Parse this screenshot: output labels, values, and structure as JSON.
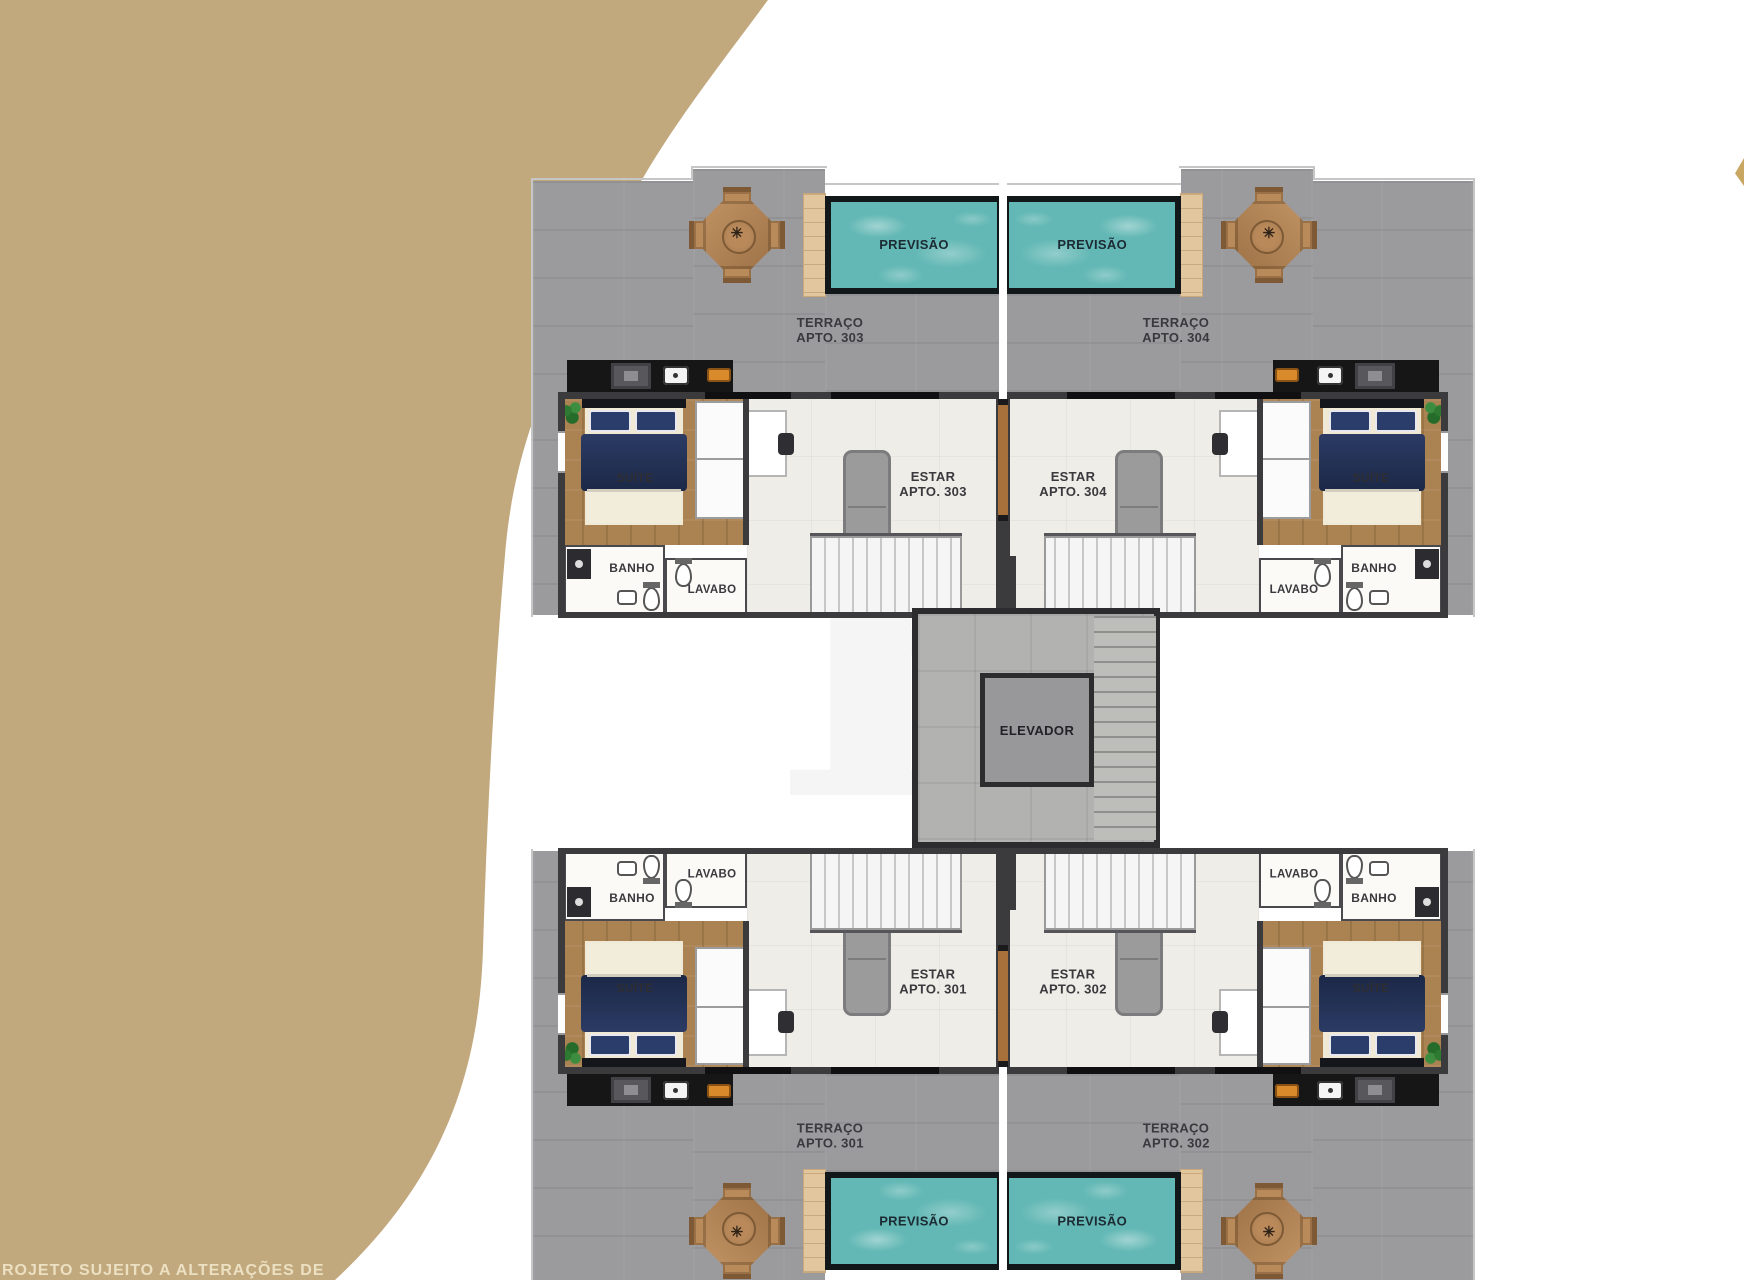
{
  "page": {
    "footer_note": "ROJETO SUJEITO A ALTERAÇÕES DE",
    "watermark_letter": "R",
    "icons": {
      "table_center": "✳"
    },
    "colors": {
      "blob": "#c2a87d",
      "terrace_concrete": "#9b9b9d",
      "pool_water": "#63b8b5",
      "pool_border": "#12171a",
      "deck_wood": "#e2c79e",
      "suite_wood": "#ab8352",
      "estar_tile": "#efede7",
      "wall": "#3b3b3e",
      "bed_navy": "#1f2c52",
      "sofa_gray": "#9b9b9b",
      "stove_orange": "#d98a2b"
    }
  },
  "plan": {
    "elevator_label": "ELEVADOR",
    "units": [
      {
        "id": "apto-303",
        "position": "top-left",
        "pool_label": "PREVISÃO",
        "terrace_line1": "TERRAÇO",
        "terrace_line2": "APTO. 303",
        "estar_line1": "ESTAR",
        "estar_line2": "APTO. 303",
        "suite_label": "SUÍTE",
        "banho_label": "BANHO",
        "lavabo_label": "LAVABO"
      },
      {
        "id": "apto-304",
        "position": "top-right",
        "pool_label": "PREVISÃO",
        "terrace_line1": "TERRAÇO",
        "terrace_line2": "APTO. 304",
        "estar_line1": "ESTAR",
        "estar_line2": "APTO. 304",
        "suite_label": "SUÍTE",
        "banho_label": "BANHO",
        "lavabo_label": "LAVABO"
      },
      {
        "id": "apto-301",
        "position": "bottom-left",
        "pool_label": "PREVISÃO",
        "terrace_line1": "TERRAÇO",
        "terrace_line2": "APTO. 301",
        "estar_line1": "ESTAR",
        "estar_line2": "APTO. 301",
        "suite_label": "SUÍTE",
        "banho_label": "BANHO",
        "lavabo_label": "LAVABO"
      },
      {
        "id": "apto-302",
        "position": "bottom-right",
        "pool_label": "PREVISÃO",
        "terrace_line1": "TERRAÇO",
        "terrace_line2": "APTO. 302",
        "estar_line1": "ESTAR",
        "estar_line2": "APTO. 302",
        "suite_label": "SUÍTE",
        "banho_label": "BANHO",
        "lavabo_label": "LAVABO"
      }
    ]
  }
}
